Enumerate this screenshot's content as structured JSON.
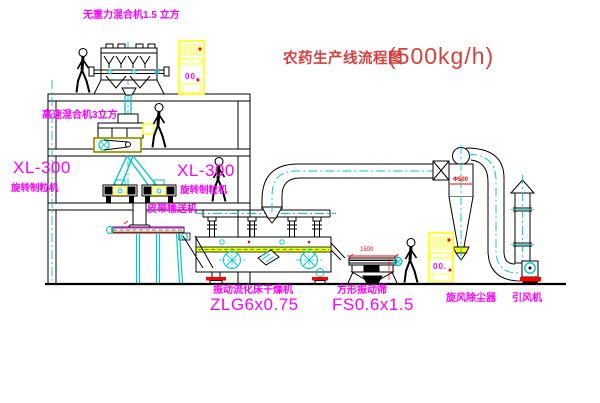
{
  "title": {
    "name": "农药生产线流程图",
    "capacity": "(500kg/h)"
  },
  "equipment_labels": {
    "gravity_free_mixer": "无重力混合机1.5 立方",
    "high_speed_mixer": "高速混合机3立方",
    "granulator_left_model": "XL-300",
    "granulator_left_name": "旋转制粒机",
    "granulator_right_model": "XL-300",
    "granulator_right_name": "旋转制粒机",
    "belt_conveyor": "皮带输送机",
    "fluid_bed_dryer_name": "振动流化床干燥机",
    "fluid_bed_dryer_model": "ZLG6x0.75",
    "square_sieve_name": "方形振动筛",
    "square_sieve_model": "FS0.6x1.5",
    "cyclone_dust_collector": "旋风除尘器",
    "induced_draft_fan": "引风机"
  },
  "dimensions": {
    "cyclone_diameter": "Φ500",
    "sieve_length": "1500"
  },
  "control_cabinets": {
    "cabinet1_display": "00.",
    "cabinet2_display": "00."
  },
  "colors": {
    "label_magenta": "#ff00ff",
    "title_red": "#d84040",
    "dimension_red": "#ff0000",
    "line_teal": "#00c8c8",
    "highlight_yellow": "#ffff00",
    "belt_green": "#00bb00",
    "line_black": "#000000",
    "background": "#ffffff"
  }
}
